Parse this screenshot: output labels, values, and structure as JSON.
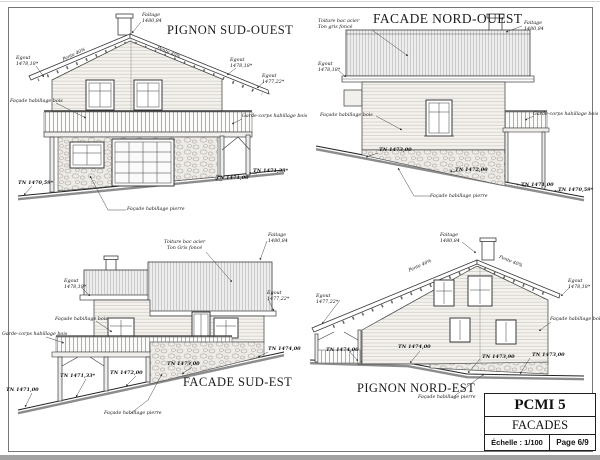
{
  "colors": {
    "ink": "#3a3a3a",
    "paper": "#ffffff",
    "ground_shadow": "#8c8c8c"
  },
  "d": {
    "sw": {
      "title": "PIGNON SUD-OUEST",
      "faitage": {
        "n": "Faitage",
        "v": "1480,84"
      },
      "pente_left": "Pente 40%",
      "pente_right": "Pente 40%",
      "egout_left": {
        "n": "Egout",
        "v": "1478,18*"
      },
      "egout_right": {
        "n": "Egout",
        "v": "1478,18*"
      },
      "egout_low": {
        "n": "Egout",
        "v": "1477,22*"
      },
      "facade_bois": "Façade habillage bois",
      "garde_corps": "Garde-corps habillage bois",
      "tn1": "TN 1470,59*",
      "tn2": "TN 1471,00",
      "tn3": "TN 1471,33*",
      "facade_pierre": "Façade habillage pierre"
    },
    "nw": {
      "title": "FACADE NORD-OUEST",
      "toiture": {
        "n": "Toiture bac acier",
        "v": "Ton gris foncé"
      },
      "faitage": {
        "n": "Faitage",
        "v": "1480,84"
      },
      "egout": {
        "n": "Egout",
        "v": "1478,18*"
      },
      "facade_bois": "Façade habillage bois",
      "garde_corps": "Garde-corps habillage bois",
      "tn1": "TN 1473,00",
      "tn2": "TN 1472,00",
      "tn3": "TN 1471,00",
      "tn4": "TN 1470,59*",
      "facade_pierre": "Façade habillage pierre"
    },
    "se": {
      "title": "FACADE SUD-EST",
      "toiture": {
        "n": "Toiture bac acier",
        "v": "Ton Gris foncé"
      },
      "faitage": {
        "n": "Faitage",
        "v": "1480,84"
      },
      "egout_left": {
        "n": "Egout",
        "v": "1478,18*"
      },
      "egout_right": {
        "n": "Egout",
        "v": "1477,22*"
      },
      "facade_bois": "Façade habillage bois",
      "garde_corps": "Garde-corps habillage bois",
      "tn1": "TN 1471,00",
      "tn2": "TN 1471,33*",
      "tn3": "TN 1472,00",
      "tn4": "TN 1473,00",
      "tn5": "TN 1474,00",
      "facade_pierre": "Façade habillage pierre"
    },
    "ne": {
      "title": "PIGNON NORD-EST",
      "faitage": {
        "n": "Faitage",
        "v": "1480,84"
      },
      "pente_left": "Pente 40%",
      "pente_right": "Pente 40%",
      "egout_left": {
        "n": "Egout",
        "v": "1477,22*"
      },
      "egout_right": {
        "n": "Egout",
        "v": "1478,18*"
      },
      "facade_bois": "Façade habillage bois",
      "tn1": "TN 1474,00",
      "tn2": "TN 1474,00",
      "tn3": "TN 1473,90",
      "tn4": "TN 1473,00",
      "facade_pierre": "Façade habillage pierre"
    },
    "tb": {
      "code": "PCMI 5",
      "name": "FACADES",
      "scale": "Échelle : 1/100",
      "page": "Page 6/9"
    }
  }
}
